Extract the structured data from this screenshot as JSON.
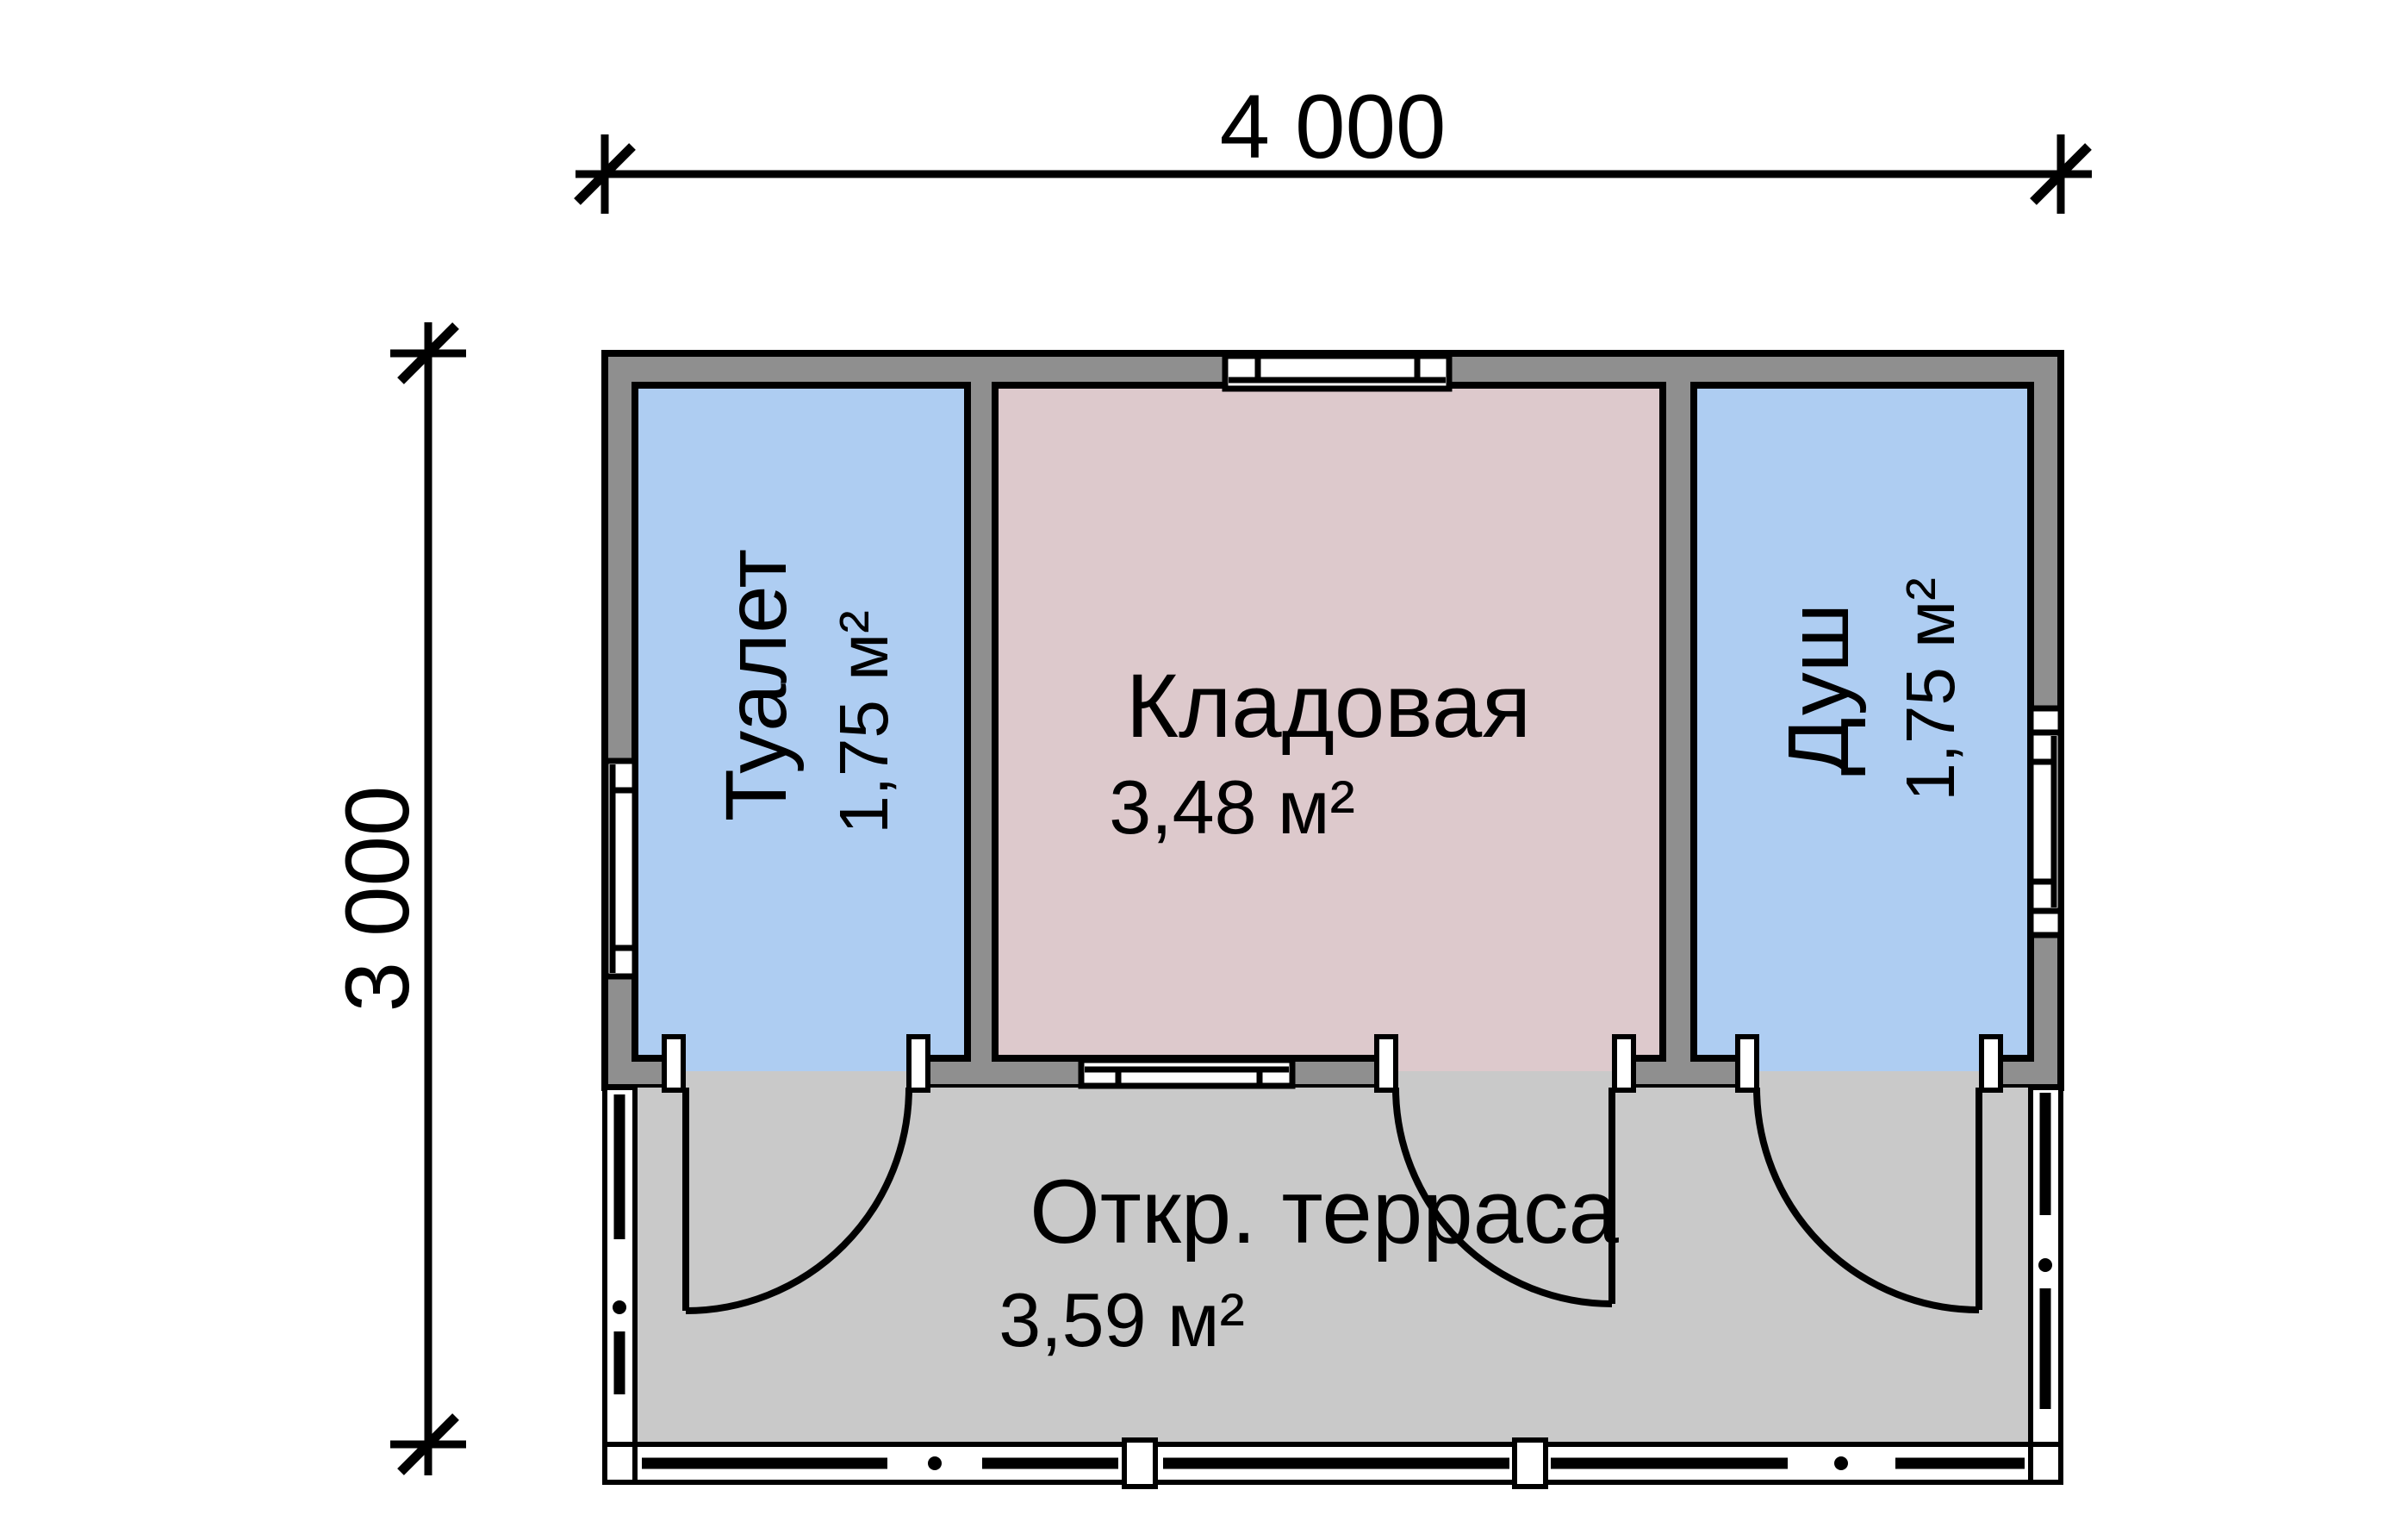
{
  "dim": {
    "width_label": "4 000",
    "height_label": "3 000"
  },
  "rooms": {
    "toilet": {
      "label": "Туалет",
      "area": "1,75 м²"
    },
    "storage": {
      "label": "Кладовая",
      "area": "3,48 м²"
    },
    "shower": {
      "label": "Душ",
      "area": "1,75 м²"
    },
    "terrace": {
      "label": "Откр. терраса",
      "area": "3,59 м²"
    }
  },
  "colors": {
    "wall": "#8f8f8f",
    "blue": "#aecdf2",
    "pink": "#ddc9cc",
    "deck": "#c9c9c9",
    "white": "#ffffff",
    "line": "#000000"
  }
}
